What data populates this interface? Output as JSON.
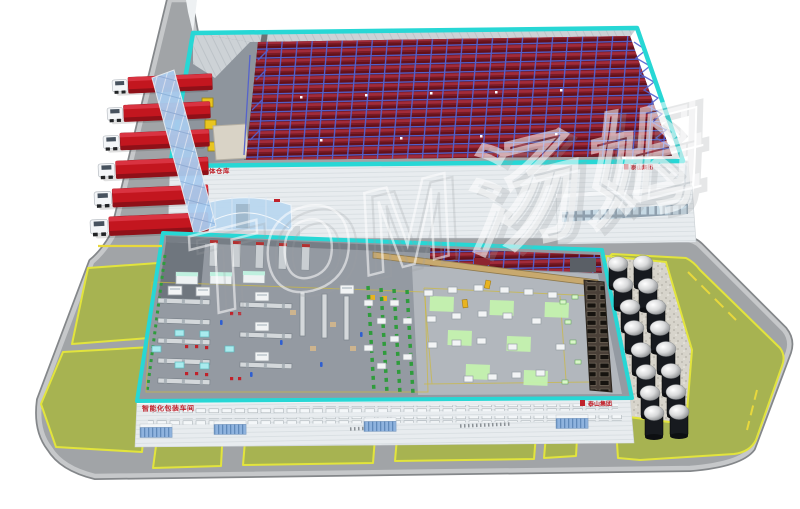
{
  "scene": {
    "description": "3D isometric rendering of a smart factory campus with automated warehouse, packing hall, truck docks and silo farm",
    "watermark": "TOM汤姆",
    "background_color": "#ffffff"
  },
  "warehouse": {
    "wall_label": "智能化立体仓库",
    "logo_label": "泰山集团",
    "dock_door_count": 3,
    "rack_red": "#a12b3a",
    "rack_frame_blue": "#5261cf"
  },
  "production_hall": {
    "wall_label": "智能化包装车间",
    "logo_label": "泰山集团",
    "dock_canopy_count": 4,
    "floor_zone_green": "#c4f1ae"
  },
  "vehicles": {
    "truck_count": 6,
    "truck_color": "#c3161f"
  },
  "silo_farm": {
    "silo_count": 16,
    "silo_body_color": "#171a1f"
  },
  "landscape": {
    "lawn_patch_count": 8,
    "lawn_green": "#a7b351",
    "lawn_border_yellow": "#e2e43c",
    "road_gray": "#a1a4a7",
    "curb_gray": "#c6c8ca",
    "gravel_pad": "#d7d4cb"
  },
  "colors": {
    "cutaway_outline_cyan": "#27d7d5",
    "glass_blue": "#a9cbee",
    "wall_gray": "#e8ecef"
  }
}
